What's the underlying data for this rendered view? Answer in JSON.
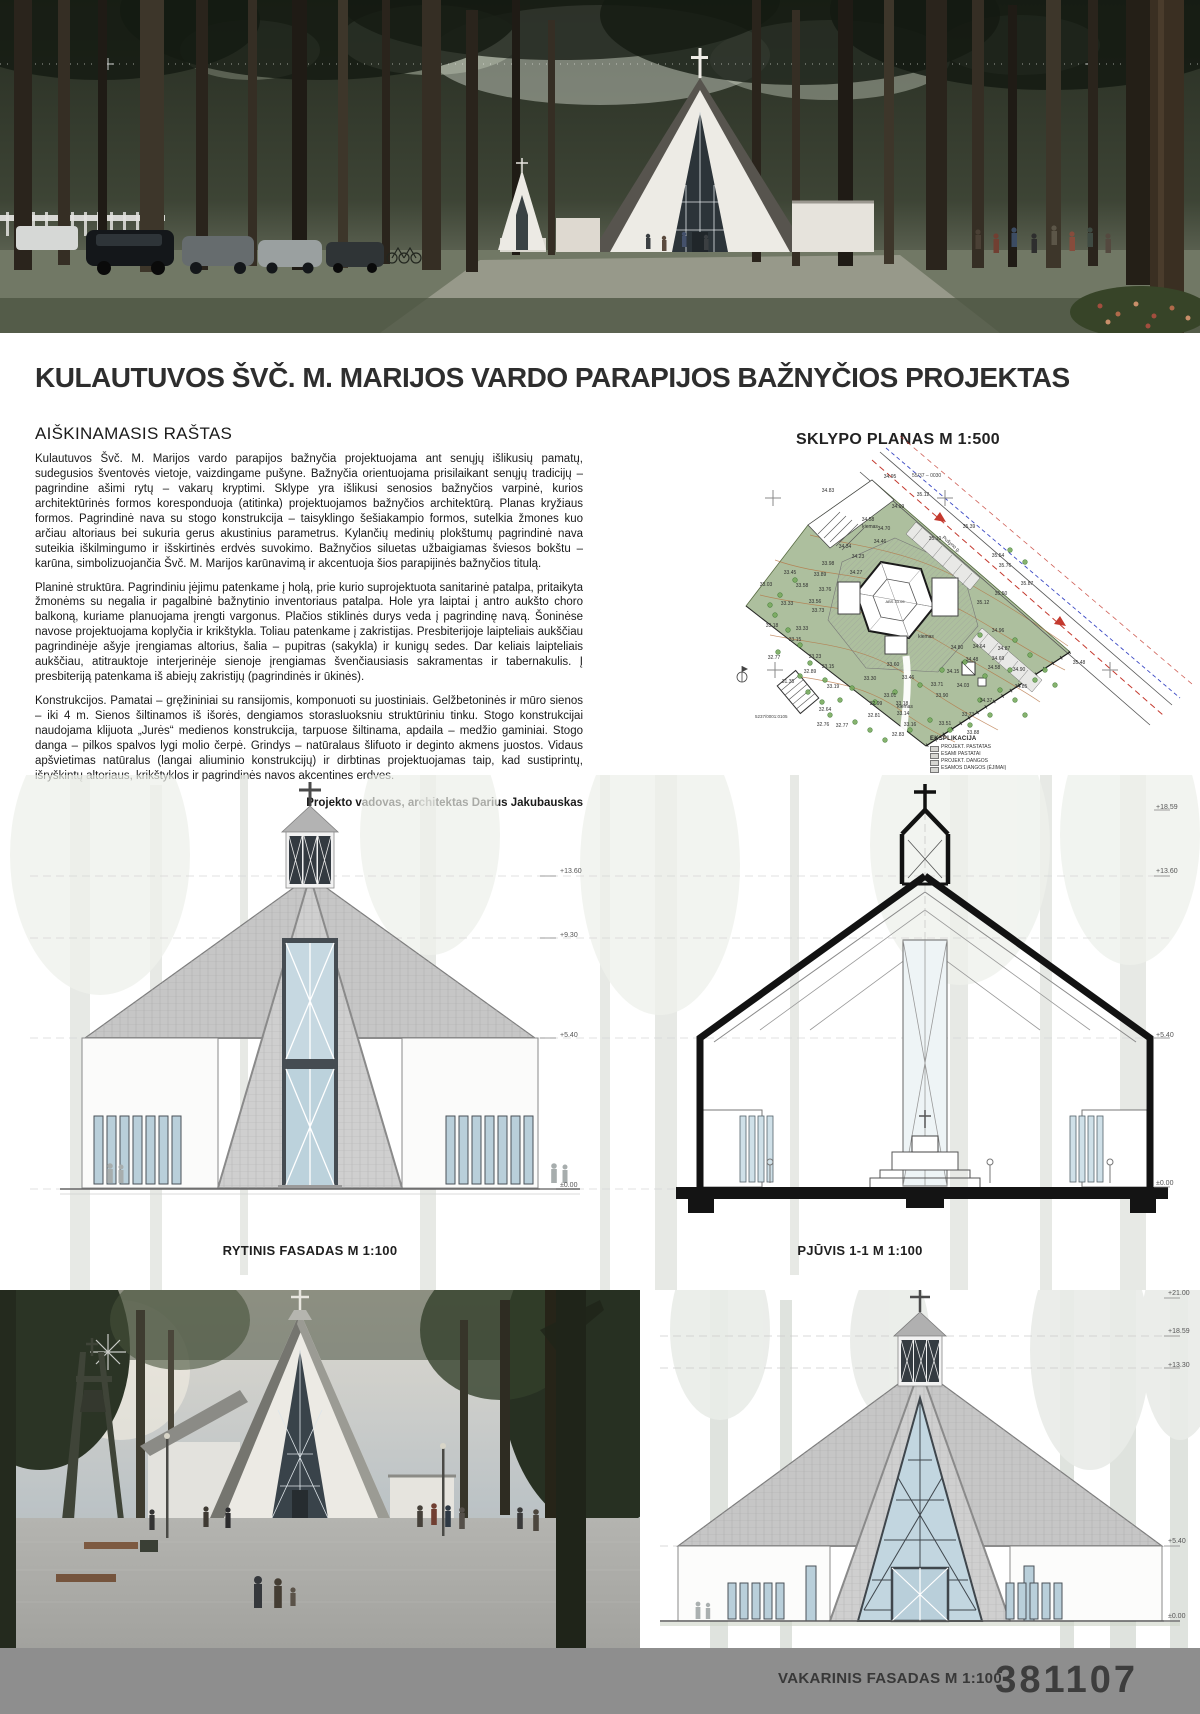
{
  "title": "KULAUTUVOS ŠVČ. M. MARIJOS VARDO PARAPIJOS BAŽNYČIOS PROJEKTAS",
  "explanatory": {
    "heading": "AIŠKINAMASIS RAŠTAS",
    "paragraphs": [
      "Kulautuvos Švč. M. Marijos vardo parapijos bažnyčia projektuojama ant senųjų išlikusių pamatų, sudegusios šventovės vietoje, vaizdingame pušyne. Bažnyčia orientuojama prisilaikant senųjų tradicijų – pagrindine ašimi rytų – vakarų kryptimi. Sklype yra išlikusi senosios bažnyčios varpinė, kurios architektūrinės formos koresponduoja (atitinka) projektuojamos bažnyčios architektūrą. Planas kryžiaus formos. Pagrindinė nava su stogo konstrukcija – taisyklingo šešiakampio formos, sutelkia žmones kuo arčiau altoriaus bei sukuria gerus akustinius parametrus. Kylančių medinių plokštumų pagrindinė nava suteikia iškilmingumo ir išskirtinės erdvės suvokimo. Bažnyčios siluetas užbaigiamas šviesos bokštu – karūna, simbolizuojančia Švč. M. Marijos karūnavimą ir akcentuoja šios parapijinės bažnyčios titulą.",
      "Planinė struktūra. Pagrindiniu įėjimu patenkame į holą, prie kurio suprojektuota sanitarinė patalpa, pritaikyta žmonėms su negalia ir pagalbinė bažnytinio inventoriaus patalpa. Hole yra laiptai į antro aukšto choro balkoną, kuriame planuojama įrengti vargonus. Plačios stiklinės durys veda į pagrindinę navą. Šoninėse navose projektuojama koplyčia ir krikštykla. Toliau patenkame į zakristijas. Presbiterijoje laipteliais aukščiau pagrindinėje ašyje įrengiamas altorius, šalia – pupitras (sakykla) ir kunigų sedes. Dar keliais laipteliais aukščiau, atitrauktoje interjerinėje sienoje įrengiamas švenčiausiasis sakramentas ir tabernakulis. Į presbiteriją patenkama iš abiejų zakristijų (pagrindinės ir ūkinės).",
      "Konstrukcijos. Pamatai – gręžininiai su ransijomis, komponuoti su juostiniais. Gelžbetoninės ir mūro sienos – iki 4 m. Sienos šiltinamos iš išorės, dengiamos storasluoksniu struktūriniu tinku. Stogo konstrukcijai naudojama klijuota „Jurės“ medienos konstrukcija, tarpuose šiltinama, apdaila – medžio gaminiai. Stogo danga – pilkos spalvos lygi molio čerpė. Grindys – natūralaus šlifuoto ir deginto akmens juostos. Vidaus apšvietimas natūralus (langai aliuminio konstrukcijų) ir dirbtinas projektuojamas taip, kad sustiprintų, išryškintų altoriaus, krikštyklos ir pagrindinės navos akcentines erdves."
    ],
    "credit": "Projekto vadovas, architektas Darius Jakubauskas"
  },
  "site_plan": {
    "heading": "SKLYPO PLANAS M 1:500",
    "parcel_label": "55/37 – 0030",
    "survey_code": "5237/0001:0105",
    "street_label": "Pušyno g.",
    "center_label": "ABS 33.05",
    "legend": {
      "heading": "EKSPLIKACIJA",
      "items": [
        "PROJEKT. PASTATAS",
        "ESAMI PASTATAI",
        "PROJEKT. DANGOS",
        "ESAMOS DANGOS (ĖJIMAI)"
      ]
    },
    "elevation_labels": [
      {
        "t": "34.95",
        "x": 210,
        "y": 47
      },
      {
        "t": "34.83",
        "x": 148,
        "y": 61
      },
      {
        "t": "35.12",
        "x": 243,
        "y": 65
      },
      {
        "t": "34.99",
        "x": 218,
        "y": 77
      },
      {
        "t": "34.58",
        "x": 188,
        "y": 90
      },
      {
        "t": "34.70",
        "x": 204,
        "y": 99
      },
      {
        "t": "35.39",
        "x": 289,
        "y": 97
      },
      {
        "t": "34.46",
        "x": 200,
        "y": 112
      },
      {
        "t": "35.10",
        "x": 255,
        "y": 109
      },
      {
        "t": "34.34",
        "x": 165,
        "y": 117
      },
      {
        "t": "34.23",
        "x": 178,
        "y": 127
      },
      {
        "t": "35.54",
        "x": 318,
        "y": 126
      },
      {
        "t": "33.98",
        "x": 148,
        "y": 134
      },
      {
        "t": "35.76",
        "x": 325,
        "y": 136
      },
      {
        "t": "34.27",
        "x": 176,
        "y": 143
      },
      {
        "t": "33.45",
        "x": 110,
        "y": 143
      },
      {
        "t": "33.89",
        "x": 140,
        "y": 145
      },
      {
        "t": "35.87",
        "x": 347,
        "y": 154
      },
      {
        "t": "33.58",
        "x": 122,
        "y": 156
      },
      {
        "t": "33.76",
        "x": 145,
        "y": 160
      },
      {
        "t": "33.03",
        "x": 86,
        "y": 155
      },
      {
        "t": "33.33",
        "x": 107,
        "y": 174
      },
      {
        "t": "33.56",
        "x": 135,
        "y": 172
      },
      {
        "t": "35.50",
        "x": 321,
        "y": 164
      },
      {
        "t": "33.73",
        "x": 138,
        "y": 181
      },
      {
        "t": "35.12",
        "x": 303,
        "y": 173
      },
      {
        "t": "33.18",
        "x": 92,
        "y": 196
      },
      {
        "t": "33.33",
        "x": 122,
        "y": 199
      },
      {
        "t": "34.96",
        "x": 318,
        "y": 201
      },
      {
        "t": "33.15",
        "x": 115,
        "y": 210
      },
      {
        "t": "32.77",
        "x": 94,
        "y": 228
      },
      {
        "t": "34.64",
        "x": 299,
        "y": 217
      },
      {
        "t": "34.87",
        "x": 324,
        "y": 219
      },
      {
        "t": "33.23",
        "x": 135,
        "y": 227
      },
      {
        "t": "34.48",
        "x": 292,
        "y": 230
      },
      {
        "t": "34.69",
        "x": 318,
        "y": 229
      },
      {
        "t": "34.58",
        "x": 314,
        "y": 238
      },
      {
        "t": "34.90",
        "x": 339,
        "y": 240
      },
      {
        "t": "35.48",
        "x": 399,
        "y": 233
      },
      {
        "t": "33.15",
        "x": 148,
        "y": 237
      },
      {
        "t": "32.89",
        "x": 130,
        "y": 242
      },
      {
        "t": "33.60",
        "x": 213,
        "y": 235
      },
      {
        "t": "34.80",
        "x": 277,
        "y": 218
      },
      {
        "t": "34.15",
        "x": 273,
        "y": 242
      },
      {
        "t": "33.30",
        "x": 190,
        "y": 249
      },
      {
        "t": "33.46",
        "x": 228,
        "y": 248
      },
      {
        "t": "33.71",
        "x": 257,
        "y": 255
      },
      {
        "t": "34.03",
        "x": 283,
        "y": 256
      },
      {
        "t": "34.85",
        "x": 341,
        "y": 257
      },
      {
        "t": "33.19",
        "x": 153,
        "y": 257
      },
      {
        "t": "33.01",
        "x": 210,
        "y": 266
      },
      {
        "t": "33.90",
        "x": 262,
        "y": 266
      },
      {
        "t": "34.37",
        "x": 306,
        "y": 271
      },
      {
        "t": "32.99",
        "x": 196,
        "y": 274
      },
      {
        "t": "33.18",
        "x": 222,
        "y": 274
      },
      {
        "t": "33.14",
        "x": 223,
        "y": 284
      },
      {
        "t": "32.81",
        "x": 194,
        "y": 286
      },
      {
        "t": "33.73",
        "x": 288,
        "y": 285
      },
      {
        "t": "32.77",
        "x": 162,
        "y": 296
      },
      {
        "t": "33.16",
        "x": 230,
        "y": 295
      },
      {
        "t": "33.51",
        "x": 265,
        "y": 294
      },
      {
        "t": "33.88",
        "x": 293,
        "y": 303
      },
      {
        "t": "32.83",
        "x": 218,
        "y": 305
      },
      {
        "t": "31.35",
        "x": 108,
        "y": 252
      },
      {
        "t": "32.64",
        "x": 145,
        "y": 280
      },
      {
        "t": "32.76",
        "x": 143,
        "y": 295
      },
      {
        "t": "kiemas",
        "x": 190,
        "y": 97
      },
      {
        "t": "kiemas",
        "x": 246,
        "y": 207
      },
      {
        "t": "kiemas",
        "x": 225,
        "y": 277
      }
    ]
  },
  "drawings": {
    "east_facade_label": "RYTINIS FASADAS M 1:100",
    "section_label": "PJŪVIS 1-1 M 1:100",
    "west_facade_label": "VAKARINIS FASADAS M 1:100",
    "east_levels": [
      {
        "t": "+13.60",
        "x": 540,
        "y": 88
      },
      {
        "t": "+9.30",
        "x": 540,
        "y": 152
      },
      {
        "t": "+5.40",
        "x": 540,
        "y": 252
      },
      {
        "t": "±0.00",
        "x": 540,
        "y": 402
      }
    ],
    "section_levels": [
      {
        "t": "+18.59",
        "x": 516,
        "y": 24
      },
      {
        "t": "+13.60",
        "x": 516,
        "y": 88
      },
      {
        "t": "+5.40",
        "x": 516,
        "y": 252
      },
      {
        "t": "±0.00",
        "x": 516,
        "y": 400
      }
    ],
    "west_levels": [
      {
        "t": "+21.00",
        "x": 528,
        "y": 0
      },
      {
        "t": "+18.59",
        "x": 528,
        "y": 38
      },
      {
        "t": "+13.30",
        "x": 528,
        "y": 72
      },
      {
        "t": "+5.40",
        "x": 528,
        "y": 248
      },
      {
        "t": "±0.00",
        "x": 528,
        "y": 323
      }
    ]
  },
  "footer": {
    "sheet_number": "381107"
  },
  "colors": {
    "footer_bar": "#8e8e8e",
    "site_green": "#adbf9e",
    "roof_gray": "#c6c6c6",
    "glass": "#c6d8e1",
    "survey_red": "#c4392e",
    "survey_blue": "#3b49c4"
  }
}
